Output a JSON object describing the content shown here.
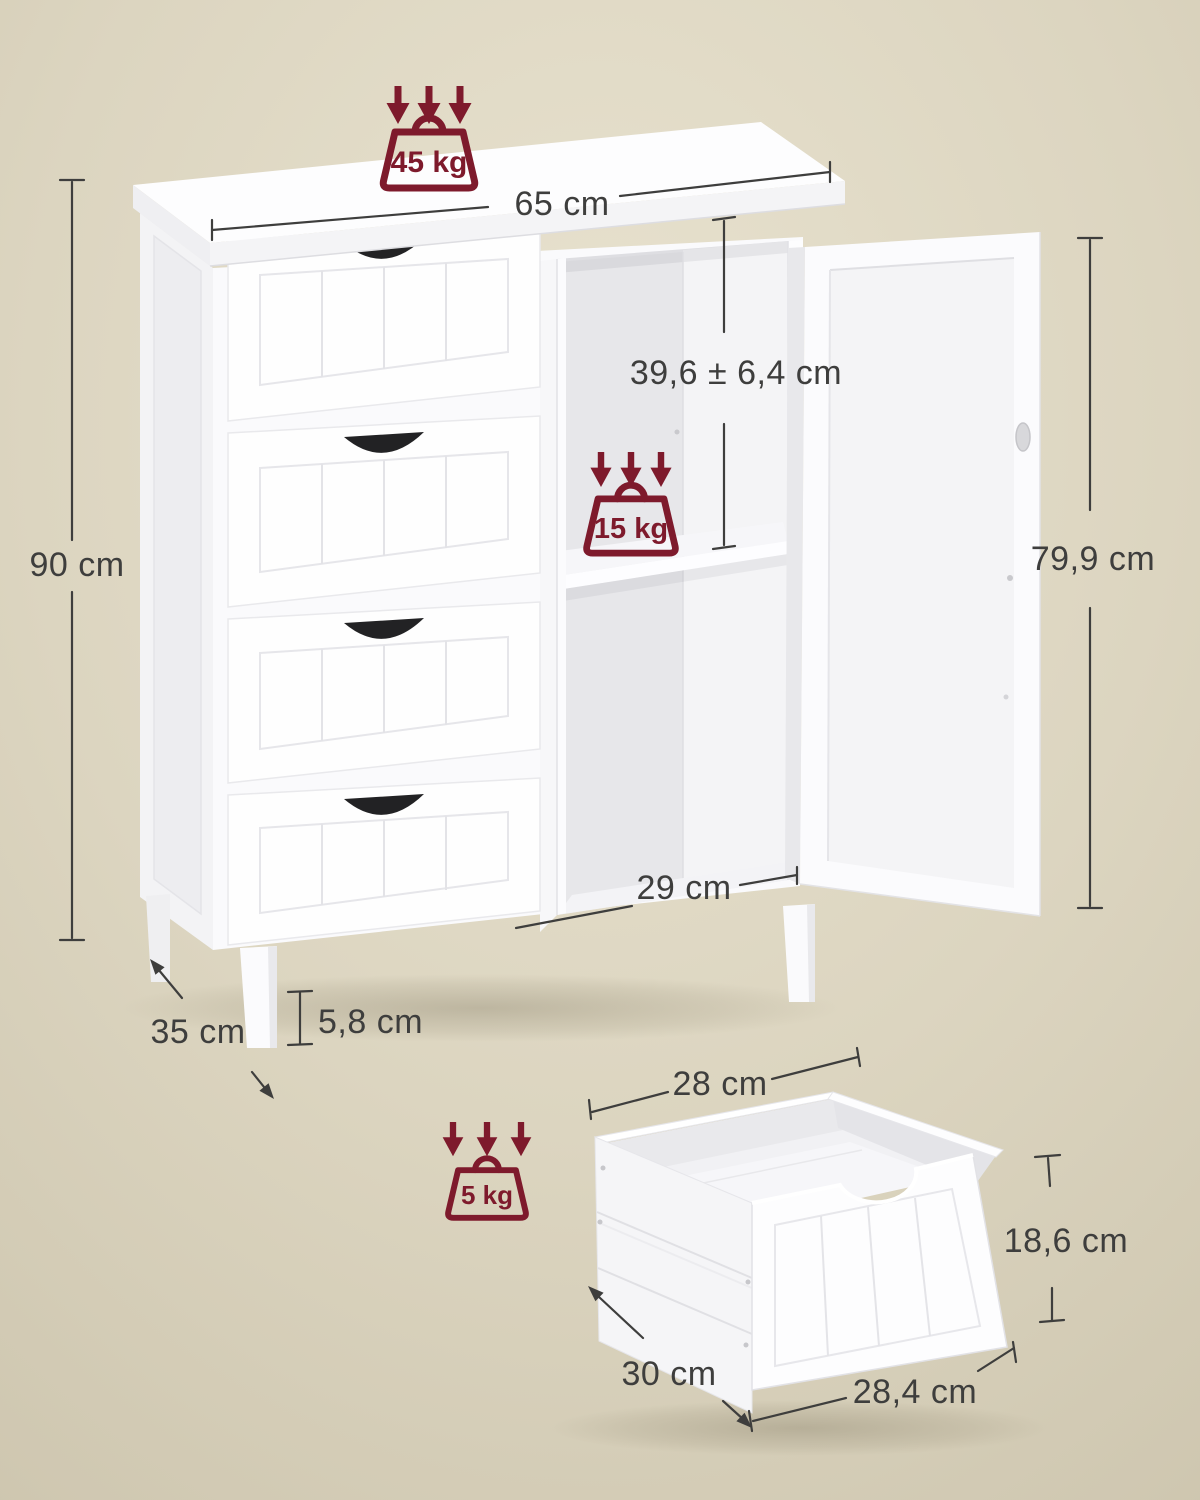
{
  "colors": {
    "background": "#DCD5C0",
    "background_light": "#E8E2CF",
    "background_dark": "#CCC4AD",
    "dimension_line": "#3E3E3D",
    "load_badge": "#7E1A2C",
    "cabinet_white": "#FBFBFD"
  },
  "cabinet": {
    "width_label": "65 cm",
    "height_label": "90 cm",
    "depth_label": "35 cm",
    "door_height_label": "79,9 cm",
    "compartment_height_label": "39,6 ± 6,4 cm",
    "compartment_width_label": "29 cm",
    "leg_height_label": "5,8 cm",
    "top_max_load_label": "45 kg",
    "shelf_max_load_label": "15 kg"
  },
  "drawer": {
    "max_load_label": "5 kg",
    "top_width_label": "28 cm",
    "front_height_label": "18,6 cm",
    "depth_label": "30 cm",
    "bottom_width_label": "28,4 cm"
  }
}
